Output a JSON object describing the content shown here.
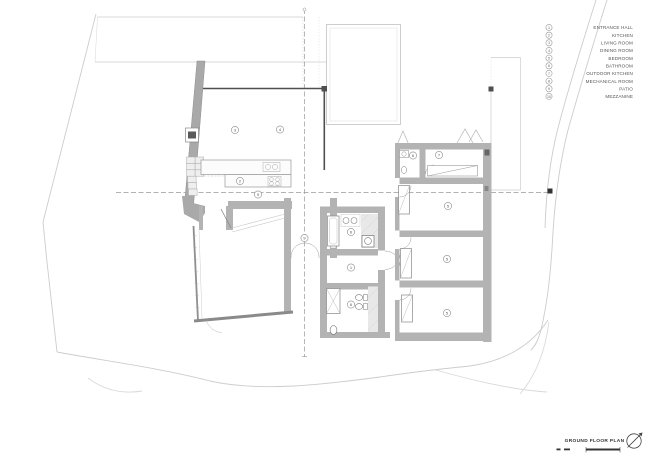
{
  "legend": {
    "items": [
      {
        "num": "1",
        "label": "ENTRANCE HALL"
      },
      {
        "num": "2",
        "label": "KITCHEN"
      },
      {
        "num": "3",
        "label": "LIVING ROOM"
      },
      {
        "num": "4",
        "label": "DINING ROOM"
      },
      {
        "num": "5",
        "label": "BEDROOM"
      },
      {
        "num": "6",
        "label": "BATHROOM"
      },
      {
        "num": "7",
        "label": "OUTDOOR KITCHEN"
      },
      {
        "num": "8",
        "label": "MECHANICAL ROOM"
      },
      {
        "num": "9",
        "label": "PATIO"
      },
      {
        "num": "10",
        "label": "MEZZANINE"
      }
    ]
  },
  "plan": {
    "room_tags": [
      "3",
      "4",
      "2",
      "9",
      "9",
      "6",
      "1",
      "6",
      "6",
      "7",
      "5",
      "5",
      "5"
    ]
  },
  "title_block": {
    "title": "GROUND FLOOR PLAN"
  },
  "colors": {
    "background": "#ffffff",
    "wall_fill": "#b3b3b3",
    "dark_line": "#4f4f4f",
    "light_line": "#cccccc",
    "section_dash": "#999999",
    "text": "#555555"
  }
}
